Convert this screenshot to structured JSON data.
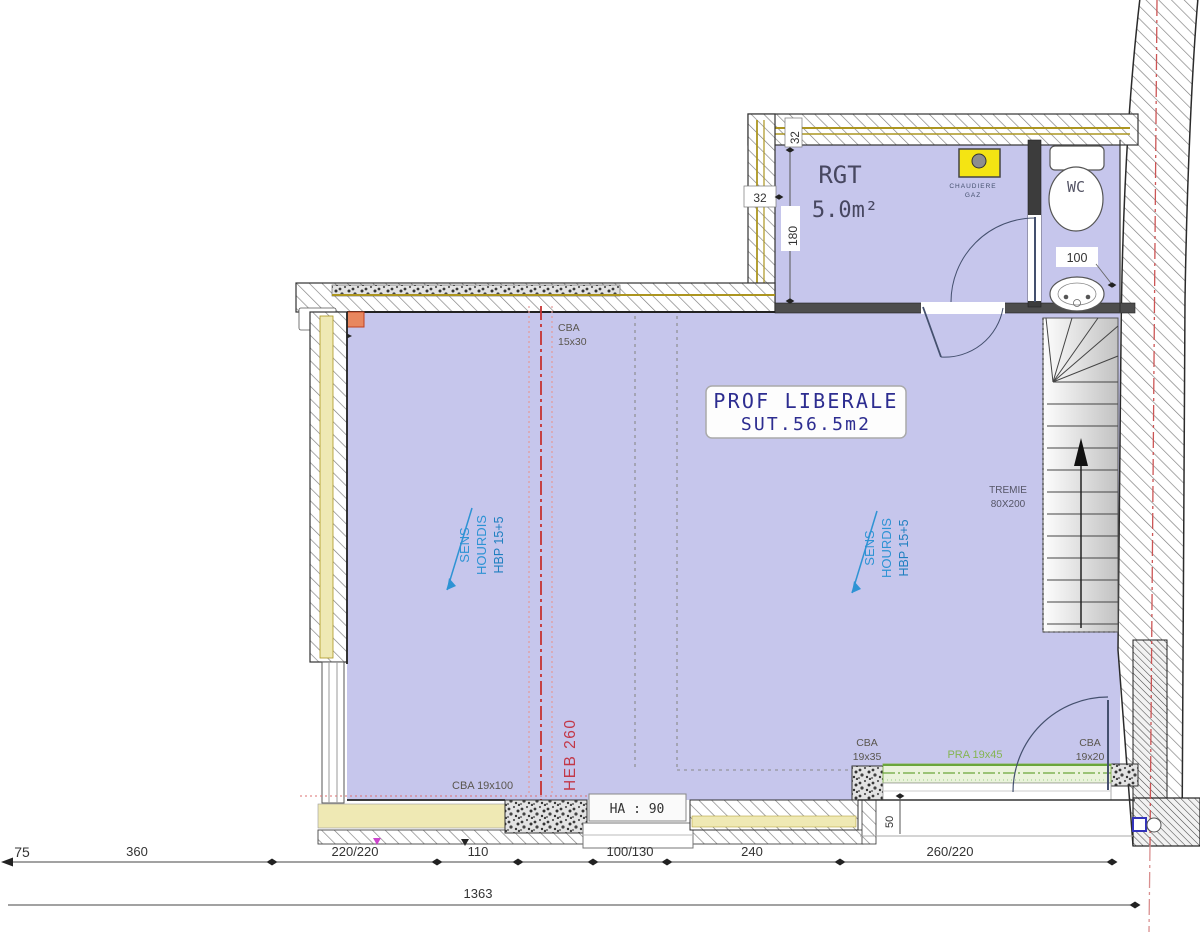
{
  "colors": {
    "room_fill": "#c6c6ec",
    "wall_insulation": "#efe9b4",
    "insulation_line": "#ac9520",
    "axis_red": "#c63232",
    "axis_pink": "#e59a9a",
    "beam_green": "#85b552",
    "lintel_fill": "#eaf3db",
    "slab_blue": "#2e93d4",
    "slab_blue_dark": "#1f7fc0",
    "title_navy": "#2d2d90",
    "boiler_yellow": "#f4e413",
    "column_orange": "#e8875f",
    "heb_red": "#c23747"
  },
  "rooms": {
    "main": {
      "title": "PROF LIBERALE",
      "subtitle": "SUT.56.5m2"
    },
    "rgt": {
      "name": "RGT",
      "area": "5.0m²"
    },
    "wc": {
      "name": "WC"
    }
  },
  "fixtures": {
    "boiler_line1": "CHAUDIERE",
    "boiler_line2": "GAZ"
  },
  "stairs": {
    "tremie_line1": "TREMIE",
    "tremie_line2": "80X200"
  },
  "slab": {
    "sens_line1": "SENS",
    "sens_line2": "HOURDIS",
    "sens_line3": "HBP 15+5"
  },
  "beams": {
    "cba_top_1": "CBA",
    "cba_top_2": "15x30",
    "cba_left": "CBA 19x100",
    "heb": "HEB 260",
    "cba_right_1": "CBA",
    "cba_right_2": "19x35",
    "pra": "PRA 19x45",
    "cba_corner_1": "CBA",
    "cba_corner_2": "19x20"
  },
  "dims": {
    "wall_40": ".40",
    "d32_top": "32",
    "d32_left": "32",
    "d180": "180",
    "d100": "100",
    "d50": "50",
    "ha90": "HA : 90",
    "bottom": [
      "75",
      "360",
      "220/220",
      "110",
      "100/130",
      "240",
      "260/220"
    ],
    "total": "1363"
  }
}
